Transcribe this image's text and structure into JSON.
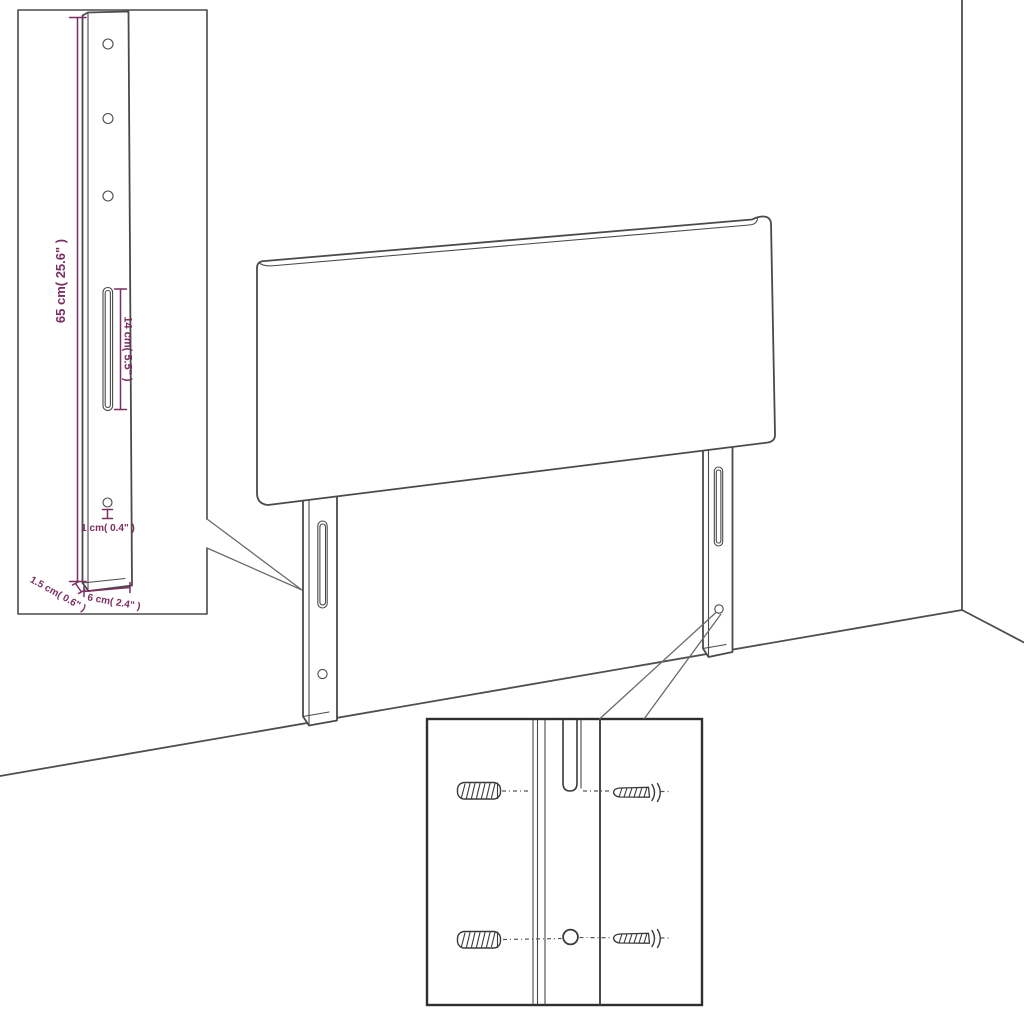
{
  "diagram_title": "headboard-mounting-dimension-diagram",
  "dimensions": {
    "leg_height": "65 cm( 25.6\" )",
    "slot_length": "14 cm( 5.5\" )",
    "hole_diameter": "1 cm( 0.4\" )",
    "leg_depth": "1.5 cm( 0.6\" )",
    "leg_width": "6 cm( 2.4\" )"
  },
  "colors": {
    "dimension_text": "#7c2d61",
    "outline": "#4a4a4a",
    "detail_box_border": "#2f2f2f",
    "background": "#ffffff"
  }
}
